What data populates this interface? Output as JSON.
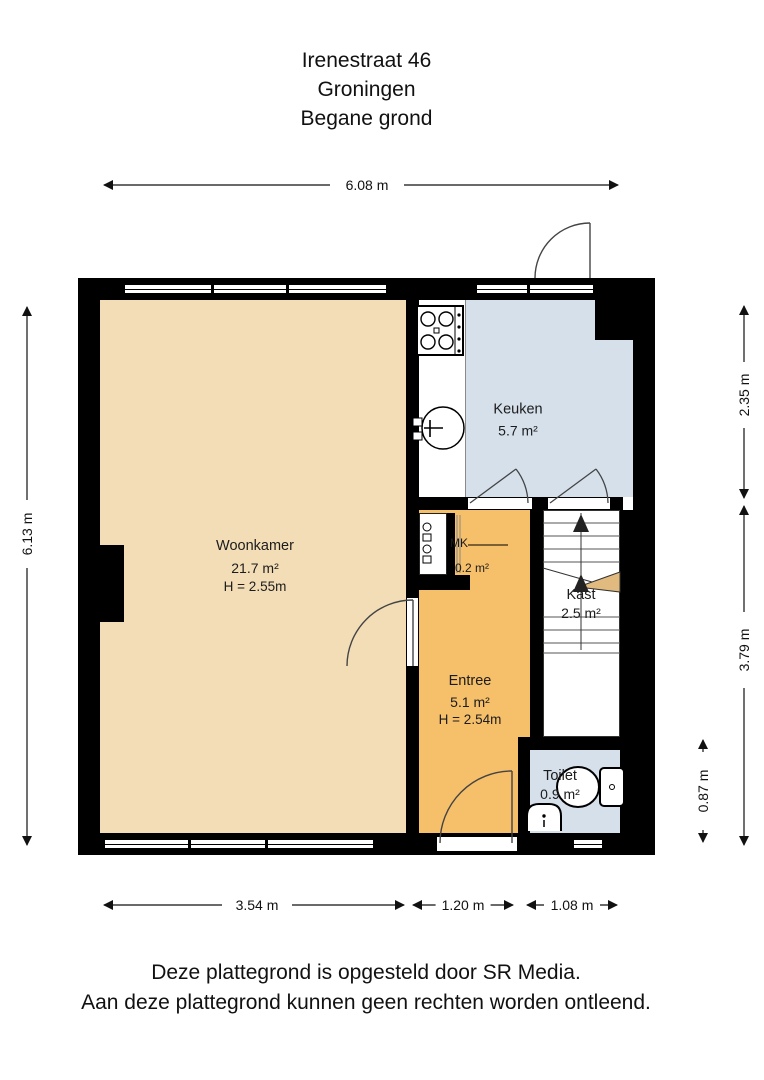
{
  "title": {
    "lines": [
      "Irenestraat 46",
      "Groningen",
      "Begane grond"
    ]
  },
  "footer": {
    "lines": [
      "Deze plattegrond is opgesteld door SR Media.",
      "Aan deze plattegrond kunnen geen rechten worden ontleend."
    ]
  },
  "rooms": {
    "woonkamer": {
      "name": "Woonkamer",
      "area": "21.7 m²",
      "height": "H = 2.55m"
    },
    "keuken": {
      "name": "Keuken",
      "area": "5.7 m²"
    },
    "entree": {
      "name": "Entree",
      "area": "5.1 m²",
      "height": "H = 2.54m"
    },
    "kast": {
      "name": "Kast",
      "area": "2.5 m²"
    },
    "toilet": {
      "name": "Toilet",
      "area": "0.9 m²"
    },
    "meterkast": {
      "name": "MK",
      "area": "0.2 m²"
    }
  },
  "dimensions": {
    "total_width": "6.08 m",
    "total_depth": "6.13 m",
    "right_top": "2.35 m",
    "right_middle": "3.79 m",
    "right_inner": "0.87 m",
    "bottom_left": "3.54 m",
    "bottom_middle": "1.20 m",
    "bottom_right": "1.08 m"
  },
  "colors": {
    "woonkamer": "#f2ddb7",
    "keuken": "#d5e0eb",
    "entree": "#f6bf6a",
    "toilet": "#d5e0eb",
    "kast": "#ffffff",
    "wall": "#000000",
    "stairs_accent": "#e0ba7e"
  }
}
